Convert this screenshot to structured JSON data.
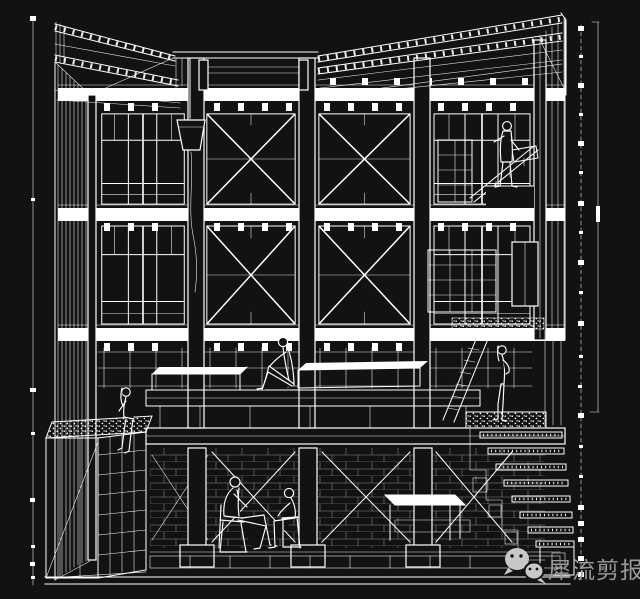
{
  "meta": {
    "description": "White line-art sectional perspective drawing of a multi-storey timber-framed building on a black background: fanned roof rafters, cross-braced bays, mullioned windows, a bucket hanging from the roof, people sitting and working on several levels, a basement with columns and scaffolding braces, a gravel-topped planter box at lower left and a cascading stair at lower right, flanked by survey scale bars."
  },
  "colors": {
    "background": "#121212",
    "line": "#ffffff",
    "watermark_text": "#9a9a9a",
    "watermark_logo": "#c8c8c8"
  },
  "watermark": {
    "logo_icon": "wechat-icon",
    "account_name": "犀流剪报"
  },
  "drawing": {
    "elements": [
      "left-survey-line",
      "right-survey-rod",
      "right-dimension-line",
      "roof-rafters-left",
      "roof-rafters-right",
      "clerestory",
      "floor-beam-1",
      "floor-beam-2",
      "floor-beam-3",
      "ground-slab",
      "cross-brace-bays",
      "window-bays",
      "hanging-bucket",
      "platform-benches",
      "planter-box",
      "basement-columns",
      "basement-masonry",
      "stairs",
      "ladder",
      "shelf-tower",
      "figure-girl-on-planter",
      "figure-sitting-on-platform",
      "figure-working-upper-right",
      "figure-standing-at-stairs",
      "figure-seated-man-left",
      "figure-seated-man-right"
    ]
  }
}
